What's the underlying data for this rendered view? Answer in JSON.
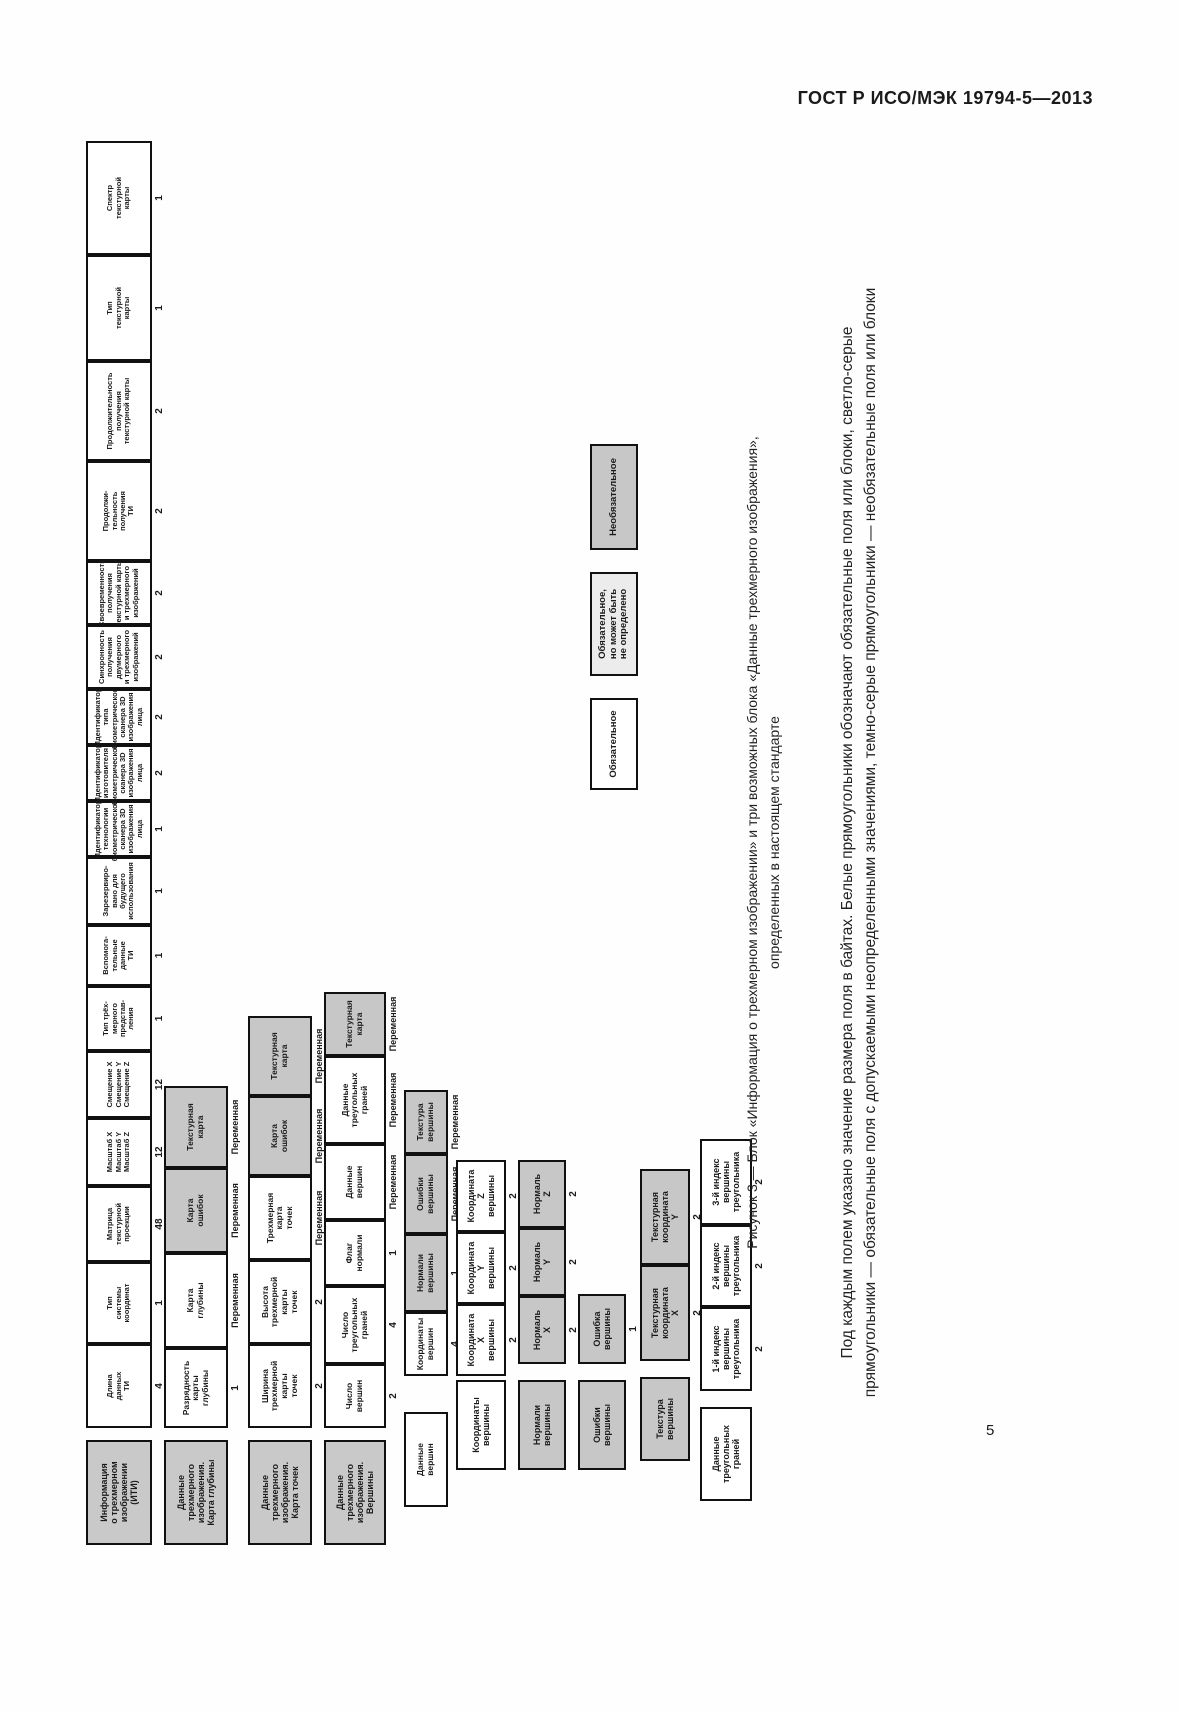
{
  "page": {
    "header_title": "ГОСТ Р ИСО/МЭК 19794-5—2013",
    "page_number": "5"
  },
  "figure": {
    "caption_line1": "Рисунок 3 — Блок «Информация о трехмерном изображении» и три возможных блока «Данные трехмерного изображения»,",
    "caption_line2": "определенных в настоящем стандарте",
    "note_line1": "Под каждым полем указано значение размера поля в байтах.  Белые прямоугольники обозначают обязательные поля или блоки, светло-серые",
    "note_line2": "прямоугольники — обязательные поля с допускаемыми неопределенными значениями, темно-серые прямоугольники — необязательные поля или блоки",
    "colors": {
      "mandatory_fill": "#ffffff",
      "undefined_allowed_fill": "#ececec",
      "optional_fill": "#c7c7c7"
    },
    "bands": [
      {
        "header": "Информация\nо трехмерном\nизображении\n(ИТИ)",
        "fields": [
          {
            "label": "Длина\nданных\nТИ",
            "size": "4",
            "style": "white"
          },
          {
            "label": "Тип\nсистемы\nкоординат",
            "size": "1",
            "style": "white"
          },
          {
            "label": "Матрица\nтекстурной\nпроекции",
            "size": "48",
            "style": "white"
          },
          {
            "label": "Масштаб X\nМасштаб Y\nМасштаб Z",
            "size": "12",
            "style": "white"
          },
          {
            "label": "Смещение X\nСмещение Y\nСмещение Z",
            "size": "12",
            "style": "white"
          },
          {
            "label": "Тип трёх-\nмерного\nпредстав-\nления",
            "size": "1",
            "style": "white"
          },
          {
            "label": "Вспомога-\nтельные\nданные\nТИ",
            "size": "1",
            "style": "white"
          },
          {
            "label": "Зарезервиро-\nвано для\nбудущего\nиспользования",
            "size": "1",
            "style": "white"
          },
          {
            "label": "Идентификатор\nтехнологии\nбиометрического\nсканера 3D\nизображения\nлица",
            "size": "1",
            "style": "white"
          },
          {
            "label": "Идентификатор\nизготовителя\nбиометрического\nсканера 3D\nизображения\nлица",
            "size": "2",
            "style": "white"
          },
          {
            "label": "Идентификатор\nтипа\nбиометрического\nсканера 3D\nизображения\nлица",
            "size": "2",
            "style": "white"
          },
          {
            "label": "Синхронность\nполучения\nдвумерного\nи трехмерного\nизображений",
            "size": "2",
            "style": "white"
          },
          {
            "label": "Своевременность\nполучения\nтекстурной карты\nи трехмерного\nизображений",
            "size": "2",
            "style": "white"
          },
          {
            "label": "Продолжи-\nтельность\nполучения\nТИ",
            "size": "2",
            "style": "white"
          },
          {
            "label": "Продолжительность\nполучения\nтекстурной карты",
            "size": "2",
            "style": "white"
          },
          {
            "label": "Тип\nтекстурной\nкарты",
            "size": "1",
            "style": "white"
          },
          {
            "label": "Спектр\nтекстурной\nкарты",
            "size": "1",
            "style": "white"
          }
        ]
      },
      {
        "header": "Данные\nтрехмерного\nизображения.\nКарта глубины",
        "fields": [
          {
            "label": "Разрядность\nкарты\nглубины",
            "size": "1",
            "style": "white"
          },
          {
            "label": "Карта\nглубины",
            "size": "Переменная",
            "style": "white"
          },
          {
            "label": "Карта\nошибок",
            "size": "Переменная",
            "style": "gray"
          },
          {
            "label": "Текстурная\nкарта",
            "size": "Переменная",
            "style": "gray"
          }
        ]
      },
      {
        "header": "Данные\nтрехмерного\nизображения.\nКарта точек",
        "fields": [
          {
            "label": "Ширина\nтрехмерной\nкарты\nточек",
            "size": "2",
            "style": "white"
          },
          {
            "label": "Высота\nтрехмерной\nкарты\nточек",
            "size": "2",
            "style": "white"
          },
          {
            "label": "Трехмерная\nкарта\nточек",
            "size": "Переменная",
            "style": "white"
          },
          {
            "label": "Карта\nошибок",
            "size": "Переменная",
            "style": "gray"
          },
          {
            "label": "Текстурная\nкарта",
            "size": "Переменная",
            "style": "gray"
          }
        ]
      },
      {
        "header": "Данные\nтрехмерного\nизображения.\nВершины",
        "fields": [
          {
            "label": "Число\nвершин",
            "size": "2",
            "style": "white"
          },
          {
            "label": "Число\nтреугольных\nграней",
            "size": "4",
            "style": "white"
          },
          {
            "label": "Флаг\nнормали",
            "size": "1",
            "style": "white"
          },
          {
            "label": "Данные\nвершин",
            "size": "Переменная",
            "style": "white"
          },
          {
            "label": "Данные\nтреугольных\nграней",
            "size": "Переменная",
            "style": "white"
          },
          {
            "label": "Текстурная\nкарта",
            "size": "Переменная",
            "style": "gray"
          }
        ]
      }
    ],
    "expansions": [
      {
        "root": {
          "label": "Данные\nвершин",
          "style": "white"
        },
        "fields": [
          {
            "label": "Координаты\nвершин",
            "size": "4",
            "style": "white"
          },
          {
            "label": "Нормали\nвершины",
            "size": "1",
            "style": "gray"
          },
          {
            "label": "Ошибки\nвершины",
            "size": "Переменная",
            "style": "gray"
          },
          {
            "label": "Текстура\nвершины",
            "size": "Переменная",
            "style": "gray"
          }
        ]
      },
      {
        "root": {
          "label": "Координаты\nвершины",
          "style": "white"
        },
        "fields": [
          {
            "label": "Координата\nX\nвершины",
            "size": "2",
            "style": "white"
          },
          {
            "label": "Координата\nY\nвершины",
            "size": "2",
            "style": "white"
          },
          {
            "label": "Координата\nZ\nвершины",
            "size": "2",
            "style": "white"
          }
        ]
      },
      {
        "root": {
          "label": "Нормали\nвершины",
          "style": "gray"
        },
        "fields": [
          {
            "label": "Нормаль\nX",
            "size": "2",
            "style": "gray"
          },
          {
            "label": "Нормаль\nY",
            "size": "2",
            "style": "gray"
          },
          {
            "label": "Нормаль\nZ",
            "size": "2",
            "style": "gray"
          }
        ]
      },
      {
        "root": {
          "label": "Ошибки\nвершины",
          "style": "gray"
        },
        "fields": [
          {
            "label": "Ошибка\nвершины",
            "size": "1",
            "style": "gray"
          }
        ]
      },
      {
        "root": {
          "label": "Текстура\nвершины",
          "style": "gray"
        },
        "fields": [
          {
            "label": "Текстурная\nкоордината\nX",
            "size": "2",
            "style": "gray"
          },
          {
            "label": "Текстурная\nкоордината\nY",
            "size": "2",
            "style": "gray"
          }
        ]
      },
      {
        "root": {
          "label": "Данные\nтреугольных\nграней",
          "style": "white"
        },
        "fields": [
          {
            "label": "1-й индекс\nвершины\nтреугольника",
            "size": "2",
            "style": "white"
          },
          {
            "label": "2-й индекс\nвершины\nтреугольника",
            "size": "2",
            "style": "white"
          },
          {
            "label": "3-й индекс\nвершины\nтреугольника",
            "size": "2",
            "style": "white"
          }
        ]
      }
    ],
    "legend": [
      {
        "label": "Обязательное",
        "style": "white"
      },
      {
        "label": "Обязательное,\nно может быть\nне определено",
        "style": "lightgray"
      },
      {
        "label": "Необязательное",
        "style": "gray"
      }
    ]
  }
}
